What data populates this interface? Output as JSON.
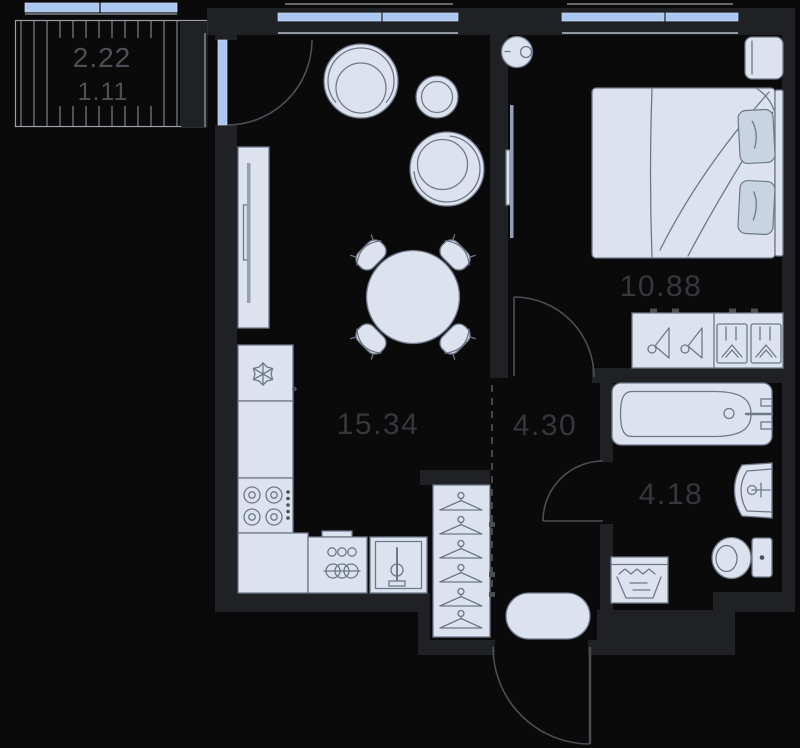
{
  "areas": {
    "balcony_total": "2.22",
    "balcony_reduced": "1.11",
    "kitchen_living": "15.34",
    "bedroom": "10.88",
    "hallway": "4.30",
    "bathroom": "4.18"
  },
  "colors": {
    "background": "#0a0a0b",
    "wall": "#1f2124",
    "furniture_fill": "#dce3ee",
    "furniture_stroke": "#6e7889",
    "soft_fill": "#c9d4e2",
    "window_glass": "#a9c7f0",
    "glass_edge": "#c9dcf5",
    "stripe": "#878d94",
    "sill": "#9aa0a6",
    "sill_inner": "#b9c0ca",
    "door_line": "#4b4f55",
    "dashed_line": "#43474d",
    "label": "#34383d",
    "label_secondary": "#4b5056",
    "tv": "#93a0b4",
    "knob": "#4a4f56"
  },
  "icons": {
    "fridge": "snowflake-icon",
    "dishwasher": "plates-rings-icon",
    "kitchen_sink": "faucet-icon",
    "washing_machine": "laundry-water-icon",
    "closet": "clothes-hanger-icon",
    "wardrobe_left": "side-hanger-icon",
    "wardrobe_right": "folded-clothes-icon"
  }
}
